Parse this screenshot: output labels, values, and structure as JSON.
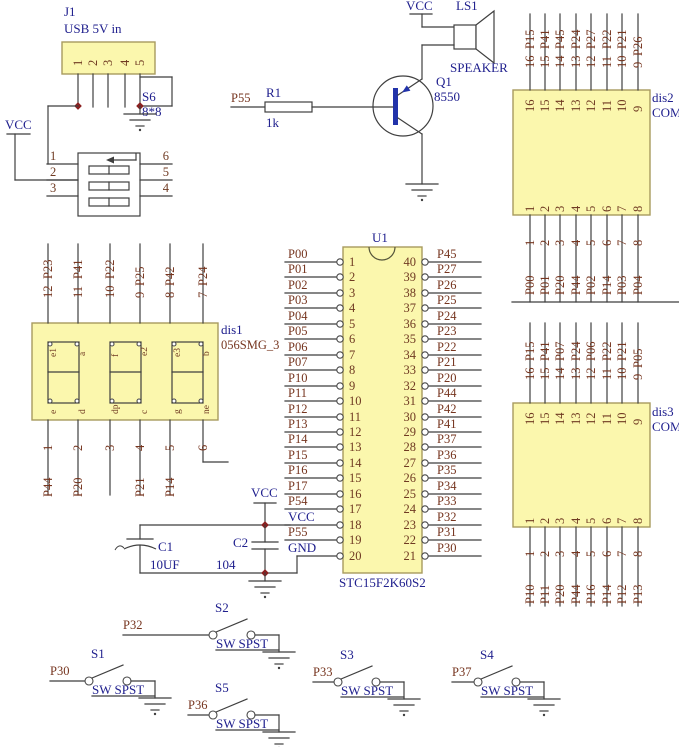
{
  "colors": {
    "component_fill": "#FBF7AD",
    "component_border": "#A89B5E",
    "wire": "#3f3f3f",
    "designator_blue": "#20208E",
    "net_maroon": "#76351F",
    "junction_red": "#8b2020",
    "transistor_blue": "#2233aa"
  },
  "power": {
    "vcc": "VCC",
    "gnd": "GND"
  },
  "j1": {
    "ref": "J1",
    "desc": "USB 5V in",
    "pins": [
      "1",
      "2",
      "3",
      "4",
      "5"
    ]
  },
  "s6": {
    "ref": "S6",
    "value": "8*8"
  },
  "dip6": {
    "left": [
      "1",
      "2",
      "3"
    ],
    "right": [
      "6",
      "5",
      "4"
    ]
  },
  "speaker": {
    "ref": "LS1",
    "name": "SPEAKER",
    "power": "VCC"
  },
  "q1": {
    "ref": "Q1",
    "value": "8550"
  },
  "r1": {
    "ref": "R1",
    "value": "1k",
    "net": "P55"
  },
  "u1": {
    "ref": "U1",
    "part": "STC15F2K60S2",
    "left": [
      [
        "1",
        "P00"
      ],
      [
        "2",
        "P01"
      ],
      [
        "3",
        "P02"
      ],
      [
        "4",
        "P03"
      ],
      [
        "5",
        "P04"
      ],
      [
        "6",
        "P05"
      ],
      [
        "7",
        "P06"
      ],
      [
        "8",
        "P07"
      ],
      [
        "9",
        "P10"
      ],
      [
        "10",
        "P11"
      ],
      [
        "11",
        "P12"
      ],
      [
        "12",
        "P13"
      ],
      [
        "13",
        "P14"
      ],
      [
        "14",
        "P15"
      ],
      [
        "15",
        "P16"
      ],
      [
        "16",
        "P17"
      ],
      [
        "17",
        "P54"
      ],
      [
        "18",
        "VCC"
      ],
      [
        "19",
        "P55"
      ],
      [
        "20",
        "GND"
      ]
    ],
    "right": [
      [
        "40",
        "P45"
      ],
      [
        "39",
        "P27"
      ],
      [
        "38",
        "P26"
      ],
      [
        "37",
        "P25"
      ],
      [
        "36",
        "P24"
      ],
      [
        "35",
        "P23"
      ],
      [
        "34",
        "P22"
      ],
      [
        "33",
        "P21"
      ],
      [
        "32",
        "P20"
      ],
      [
        "31",
        "P44"
      ],
      [
        "30",
        "P42"
      ],
      [
        "29",
        "P41"
      ],
      [
        "28",
        "P37"
      ],
      [
        "27",
        "P36"
      ],
      [
        "26",
        "P35"
      ],
      [
        "25",
        "P34"
      ],
      [
        "24",
        "P33"
      ],
      [
        "23",
        "P32"
      ],
      [
        "22",
        "P31"
      ],
      [
        "21",
        "P30"
      ]
    ]
  },
  "power_caps": {
    "vcc": "VCC",
    "c1_ref": "C1",
    "c1_val": "10UF",
    "c2_ref": "C2",
    "c2_val": "104"
  },
  "dis1": {
    "ref": "dis1",
    "part": "056SMG_3",
    "top": [
      [
        "12",
        "P23"
      ],
      [
        "11",
        "P41"
      ],
      [
        "10",
        "P22"
      ],
      [
        "9",
        "P25"
      ],
      [
        "8",
        "P42"
      ],
      [
        "7",
        "P24"
      ]
    ],
    "bottom": [
      [
        "1",
        "P44"
      ],
      [
        "2",
        "P20"
      ],
      [
        "3",
        ""
      ],
      [
        "4",
        "P21"
      ],
      [
        "5",
        "P14"
      ],
      [
        "6",
        ""
      ]
    ],
    "digits": [
      [
        "e1",
        "a",
        "e",
        "d"
      ],
      [
        "f",
        "e2",
        "dp",
        "c"
      ],
      [
        "e3",
        "b",
        "g",
        "ne"
      ]
    ]
  },
  "dis2": {
    "ref": "dis2",
    "part": "COM",
    "top": [
      [
        "16",
        "P15"
      ],
      [
        "15",
        "P41"
      ],
      [
        "14",
        "P45"
      ],
      [
        "13",
        "P24"
      ],
      [
        "12",
        "P27"
      ],
      [
        "11",
        "P22"
      ],
      [
        "10",
        "P21"
      ],
      [
        "9",
        "P26"
      ]
    ],
    "bottom": [
      [
        "1",
        "P00"
      ],
      [
        "2",
        "P01"
      ],
      [
        "3",
        "P20"
      ],
      [
        "4",
        "P44"
      ],
      [
        "5",
        "P02"
      ],
      [
        "6",
        "P14"
      ],
      [
        "7",
        "P03"
      ],
      [
        "8",
        "P04"
      ]
    ]
  },
  "dis3": {
    "ref": "dis3",
    "part": "COM",
    "top": [
      [
        "16",
        "P15"
      ],
      [
        "15",
        "P41"
      ],
      [
        "14",
        "P07"
      ],
      [
        "13",
        "P24"
      ],
      [
        "12",
        "P06"
      ],
      [
        "11",
        "P22"
      ],
      [
        "10",
        "P21"
      ],
      [
        "9",
        "P05"
      ]
    ],
    "bottom": [
      [
        "1",
        "P10"
      ],
      [
        "2",
        "P11"
      ],
      [
        "3",
        "P20"
      ],
      [
        "4",
        "P44"
      ],
      [
        "5",
        "P16"
      ],
      [
        "6",
        "P14"
      ],
      [
        "7",
        "P12"
      ],
      [
        "8",
        "P13"
      ]
    ]
  },
  "switches": [
    {
      "ref": "S1",
      "net": "P30",
      "type": "SW SPST"
    },
    {
      "ref": "S2",
      "net": "P32",
      "type": "SW SPST"
    },
    {
      "ref": "S3",
      "net": "P33",
      "type": "SW SPST"
    },
    {
      "ref": "S4",
      "net": "P37",
      "type": "SW SPST"
    },
    {
      "ref": "S5",
      "net": "P36",
      "type": "SW SPST"
    }
  ]
}
